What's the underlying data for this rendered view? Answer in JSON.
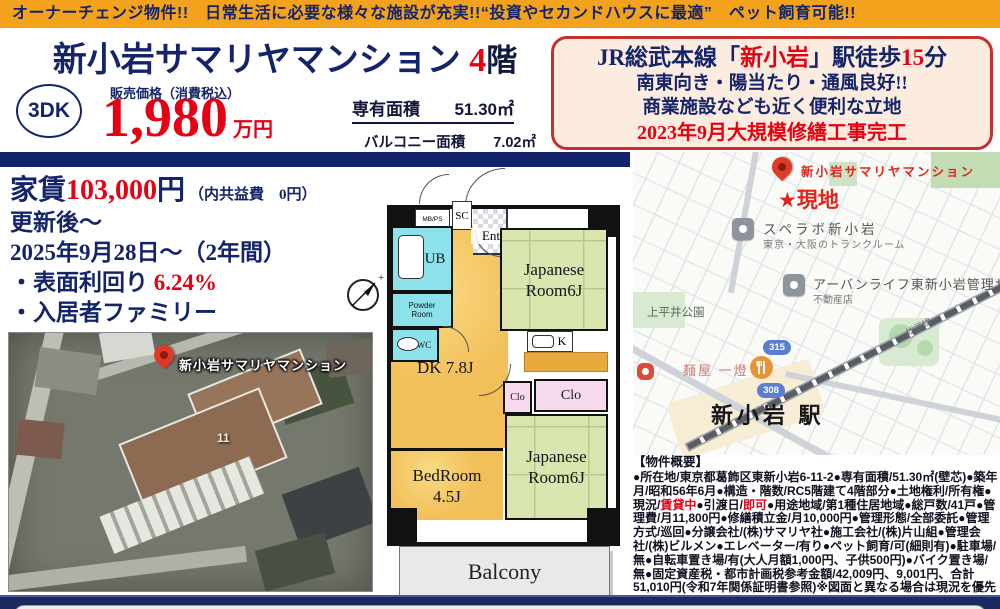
{
  "banner": {
    "text": "オーナーチェンジ物件!!　日常生活に必要な様々な施設が充実!!“投資やセカンドハウスに最適”　ペット飼育可能!!"
  },
  "header": {
    "title": "新小岩サマリヤマンション ",
    "floor_number": "4",
    "floor_suffix": "階",
    "layout_badge": "3DK",
    "price_label": "販売価格（消費税込）",
    "price_value": "1,980",
    "price_unit": "万円",
    "area1_label": "専有面積",
    "area1_value": "51.30㎡",
    "area2_label": "バルコニー面積",
    "area2_value": "7.02㎡"
  },
  "highlight": {
    "l1a": "JR総武本線「",
    "l1b": "新小岩",
    "l1c": "」駅徒歩",
    "l1d": "15",
    "l1e": "分",
    "l2": "南東向き・陽当たり・通風良好!!",
    "l3": "商業施設なども近く便利な立地",
    "l4": "2023年9月大規模修繕工事完工"
  },
  "rent": {
    "label": "家賃",
    "value": "103,000",
    "unit": "円",
    "note": "（内共益費　0円）",
    "line2": "更新後～",
    "line3": "2025年9月28日～（2年間）",
    "yield_label": "・表面利回り ",
    "yield_value": "6.24%",
    "line5": "・入居者ファミリー"
  },
  "floor_plan": {
    "mbps": "MB/PS",
    "sc": "SC",
    "ent": "Ent",
    "ub": "UB",
    "powder1": "Powder",
    "powder2": "Room",
    "wc": "WC",
    "jp_top1": "Japanese",
    "jp_top2": "Room6J",
    "k": "K",
    "dk": "DK 7.8J",
    "clo_left": "Clo",
    "clo_right": "Clo",
    "bed1": "BedRoom",
    "bed2": "4.5J",
    "jp_bot1": "Japanese",
    "jp_bot2": "Room6J",
    "balcony": "Balcony"
  },
  "aerial": {
    "pin_label": "新小岩サマリヤマンション",
    "building_number": "11"
  },
  "map": {
    "pin_label": "新小岩サマリヤマンション",
    "site_label": "★現地",
    "poi1": "スペラボ新小岩",
    "poi1_sub": "東京・大阪のトランクルーム",
    "poi2": "アーバンライフ東新小岩管理サ",
    "poi2_sub": "不動産店",
    "park": "上平井公園",
    "restaurant": "麺屋 一燈",
    "route1": "315",
    "route2": "308",
    "rail_label": "総武線",
    "station": "新小岩 駅"
  },
  "overview": {
    "heading": "【物件概要】",
    "part1": "●所在地/東京都葛飾区東新小岩6-11-2●専有面積/51.30㎡(壁芯)●築年月/昭和56年6月●構造・階数/RC5階建て4階部分●土地権利/所有権●現況/",
    "red1": "賃貸中",
    "part2": "●引渡日/",
    "red2": "即可",
    "part3": "●用途地域/第1種住居地域●総戸数/41戸●管理費/月11,800円●修繕積立金/月10,000円●管理形態/全部委託●管理方式/巡回●分譲会社/(株)サマリヤ社●施工会社/(株)片山組●管理会社/(株)ビルメン●エレベーター/有り●ペット飼育/可(細則有)●駐車場/無●自転車置き場/有(大人月額1,000円、子供500円)●バイク置き場/無●固定資産税・都市計画税参考金額/42,009円、9,001円、合計51,010円(令和7年関係証明書参照)※図面と異なる場合は現況を優先します。"
  },
  "colors": {
    "banner_orange": "#f3a31b",
    "navy": "#14246a",
    "red": "#e60013",
    "highlight_bg": "#fcece0",
    "highlight_border": "#c53030",
    "floor_orange": "#f2bf58",
    "tatami_green": "#d9e6b0",
    "wet_cyan": "#8ce1ea",
    "closet_pink": "#f6d9ec",
    "balcony_gray": "#e9e9e7",
    "footer_navy": "#1b2a5e"
  }
}
